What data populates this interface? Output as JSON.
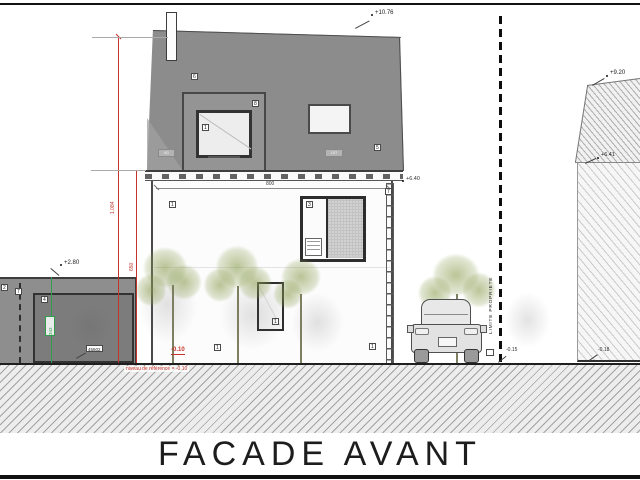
{
  "title": "FACADE AVANT",
  "levels": {
    "ridge": "+10.76",
    "eaves": "+6.40",
    "garage_top": "+2.80",
    "neighbor_ridge": "+9.20",
    "neighbor_eaves": "+6.41",
    "ground_house": "-0.10",
    "ground_at_limit": "-0.15",
    "ground_at_neighbor": "-0.18"
  },
  "dimensions": {
    "facade_width": "800",
    "total_height": "1.084",
    "eaves_height": "650",
    "garage_height": "343"
  },
  "notes": {
    "reference": "niveau de référence = -0.10",
    "garage_reference": "niveau de référence garage",
    "property_limit": "LIMITE PROPRIETE"
  },
  "markers": {
    "roof": "6",
    "dormer": "8",
    "skylight": "5",
    "dormer_window": "1",
    "wall_upper_left": "1",
    "window_upper": "3",
    "window_lower": "1",
    "base_left": "1",
    "base_right": "1",
    "garage_wall": "2",
    "garage_downpipe": "7",
    "garage_door": "4",
    "downpipe_right": "7",
    "roof_chip_left": "60",
    "roof_chip_right": "157",
    "garage_door_tag": "45602"
  }
}
